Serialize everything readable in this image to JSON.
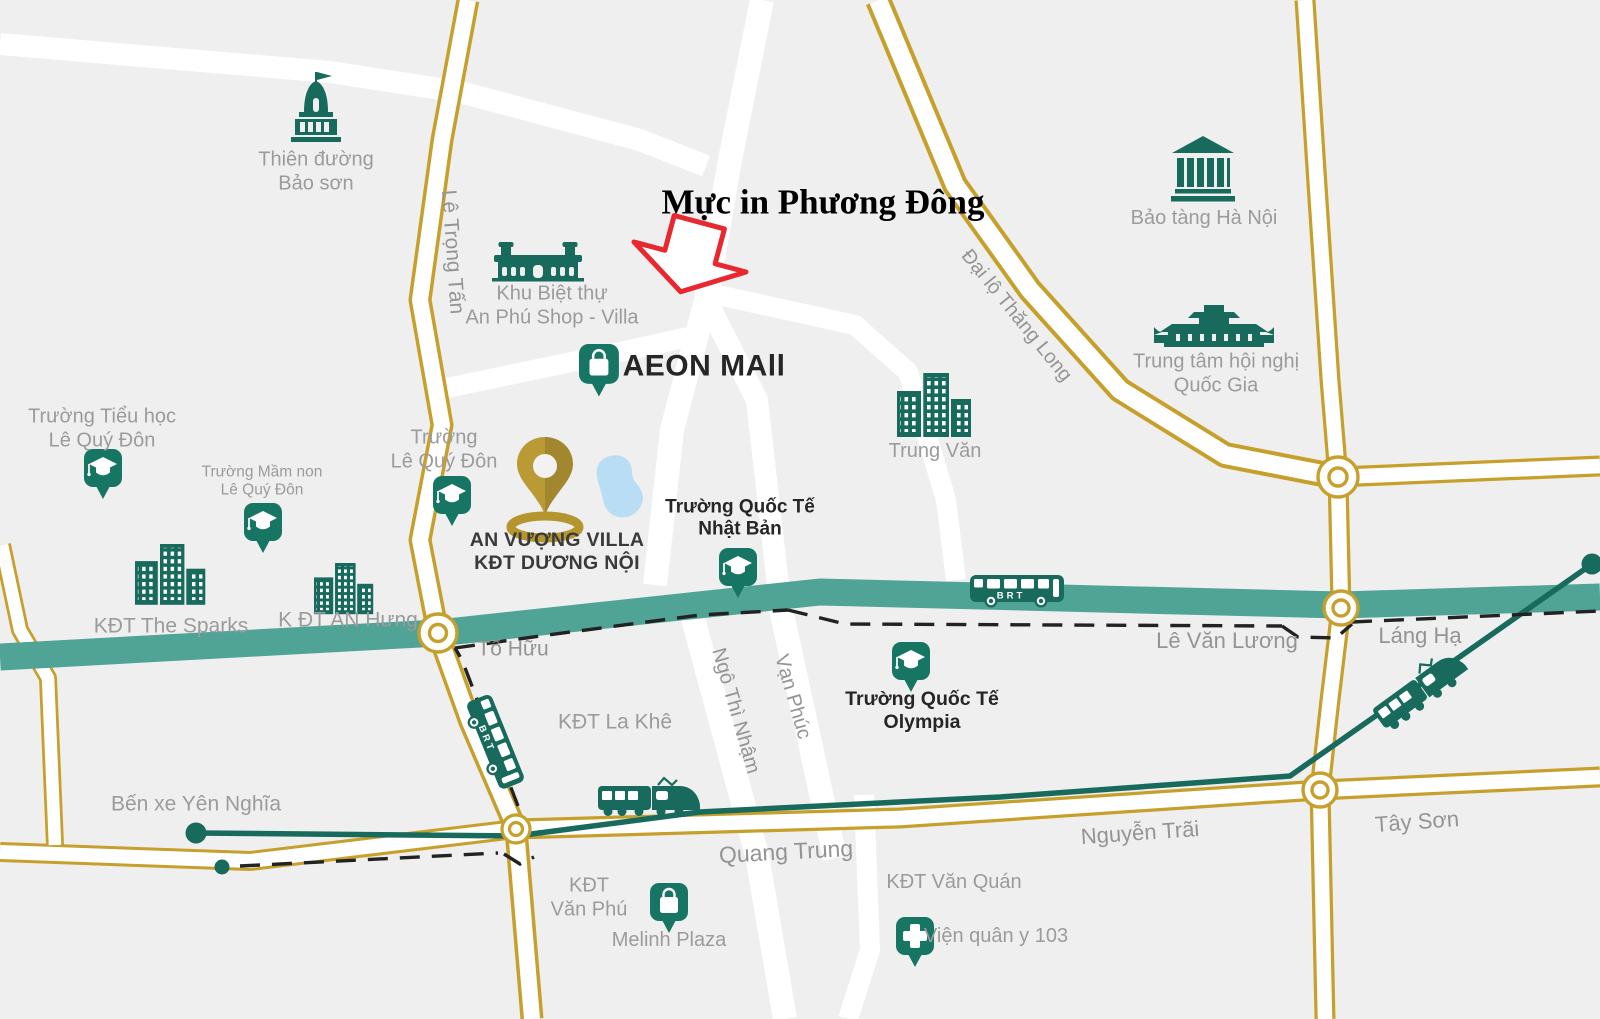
{
  "title": "Mực in Phương Đông",
  "brt_badge": "BRT",
  "colors": {
    "background": "#efeff0",
    "road_gold": "#c6a02b",
    "road_white": "#ffffff",
    "brt_corridor_teal": "#4fa496",
    "landmark_green": "#176a5c",
    "pin_green": "#177663",
    "gold_pin": "#b5952e",
    "lake_blue": "#b9ddf4",
    "arrow_red": "#e8282e",
    "label_gray": "#9b9b9b",
    "label_dark": "#262626"
  },
  "places": {
    "thien_duong_bao_son": {
      "lines": [
        "Thiên đường",
        "Bảo sơn"
      ],
      "icon": "palace-icon"
    },
    "khu_biet_thu": {
      "lines": [
        "Khu Biệt thự",
        "An Phú Shop - Villa"
      ],
      "icon": "villa-icon"
    },
    "aeon_mall": {
      "label": "AEON MAll",
      "icon": "shopping-bag-pin-icon"
    },
    "bao_tang_ha_noi": {
      "label": "Bảo tàng Hà Nội",
      "icon": "museum-icon"
    },
    "trung_tam_hoi_nghi": {
      "lines": [
        "Trung tâm hội nghị",
        "Quốc Gia"
      ],
      "icon": "convention-center-icon"
    },
    "truong_tieu_hoc_lqd": {
      "lines": [
        "Trường Tiểu học",
        "Lê Quý Đôn"
      ],
      "icon": "school-pin-icon"
    },
    "truong_mam_non_lqd": {
      "lines": [
        "Trường Mầm non",
        "Lê Quý Đôn"
      ],
      "icon": "school-pin-icon"
    },
    "truong_lqd": {
      "lines": [
        "Trường",
        "Lê Quý Đôn"
      ],
      "icon": "school-pin-icon"
    },
    "an_vuong_villa": {
      "lines": [
        "AN VƯỢNG VILLA",
        "KĐT DƯƠNG NỘI"
      ],
      "icon": "gold-map-pin-icon"
    },
    "truong_quoc_te_nhat_ban": {
      "lines": [
        "Trường Quốc Tế",
        "Nhật Bản"
      ],
      "icon": "school-pin-icon"
    },
    "truong_quoc_te_olympia": {
      "lines": [
        "Trường Quốc Tế",
        "Olympia"
      ],
      "icon": "school-pin-icon"
    },
    "trung_van": {
      "label": "Trung Văn",
      "icon": "buildings-icon"
    },
    "kdt_the_sparks": {
      "label": "KĐT The Sparks",
      "icon": "buildings-icon"
    },
    "kdt_an_hung": {
      "label": "K ĐT AN Hưng",
      "icon": "buildings-icon"
    },
    "kdt_la_khe": {
      "label": "KĐT La Khê"
    },
    "kdt_van_phu": {
      "lines": [
        "KĐT",
        "Văn Phú"
      ]
    },
    "kdt_van_quan": {
      "label": "KĐT Văn Quán"
    },
    "melinh_plaza": {
      "label": "Melinh Plaza",
      "icon": "shopping-bag-pin-icon"
    },
    "vien_quan_y_103": {
      "label": "Viện quân y 103",
      "icon": "hospital-pin-icon"
    },
    "ben_xe_yen_nghia": {
      "label": "Bến xe Yên Nghĩa"
    }
  },
  "roads": {
    "le_trong_tan": "Lê Trọng Tấn",
    "dai_lo_thang_long": "Đại lộ Thăng Long",
    "to_huu": "Tố Hữu",
    "le_van_luong": "Lê Văn Lương",
    "lang_ha": "Láng Hạ",
    "ngo_thi_nham": "Ngô Thì Nhậm",
    "van_phuc": "Vạn Phúc",
    "quang_trung": "Quang Trung",
    "nguyen_trai": "Nguyễn Trãi",
    "tay_son": "Tây Sơn"
  }
}
